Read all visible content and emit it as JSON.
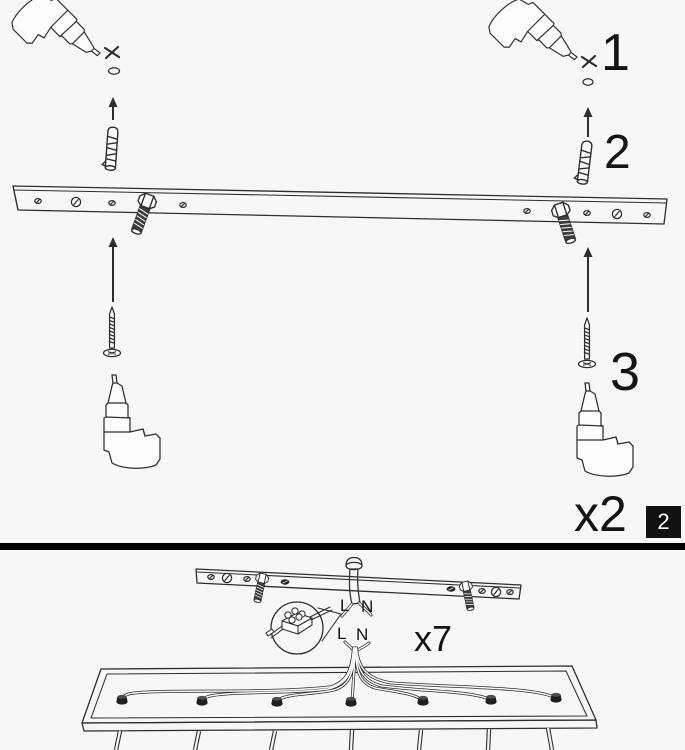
{
  "sheet": {
    "type": "assembly-instructions",
    "steps_shown": [
      "2"
    ]
  },
  "step_top": {
    "step_badge": "2",
    "quantity_label": "x2",
    "callouts": {
      "c1": "1",
      "c2": "2",
      "c3": "3"
    }
  },
  "step_bottom": {
    "quantity_label": "x7",
    "wire_labels_supply": {
      "live": "L",
      "neutral": "N"
    },
    "wire_labels_fixture": {
      "live": "L",
      "neutral": "N"
    }
  },
  "colors": {
    "background": "#f7f7f7",
    "line": "#2e2e2e",
    "divider": "#000000",
    "badge_bg": "#111111",
    "badge_text": "#ffffff",
    "metal_dark": "#3d3d3d"
  }
}
